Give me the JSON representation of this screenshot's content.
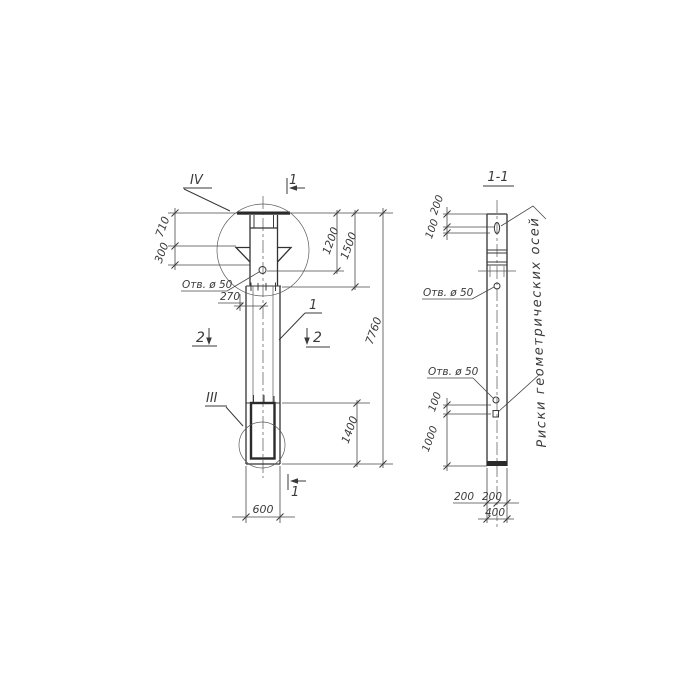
{
  "elevation": {
    "detail_top": "IV",
    "detail_bottom": "III",
    "section1": "1",
    "section2": "2",
    "piece_mark": "1",
    "hole_note": "Отв. ø 50",
    "dims": {
      "d710": "710",
      "d300": "300",
      "d270": "270",
      "d1200": "1200",
      "d1500": "1500",
      "d7760": "7760",
      "d1400": "1400",
      "d600": "600"
    }
  },
  "section": {
    "title": "1-1",
    "hole_note_upper": "Отв. ø 50",
    "hole_note_lower": "Отв. ø 50",
    "axis_note": "Риски геометрических осей",
    "dims": {
      "d200_top": "200",
      "d100_top": "100",
      "d100_mid": "100",
      "d1000": "1000",
      "d200_left": "200",
      "d200_right": "200",
      "d400": "400"
    }
  }
}
